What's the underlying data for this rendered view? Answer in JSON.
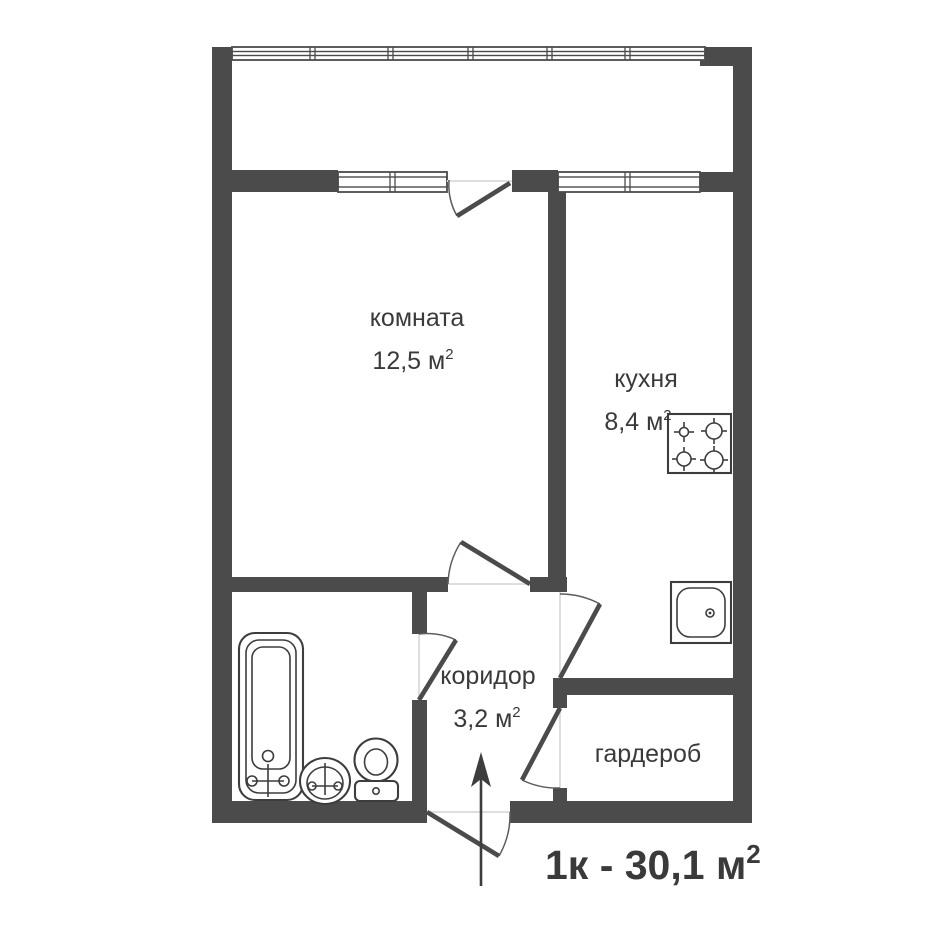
{
  "plan": {
    "type": "floor-plan",
    "rooms": [
      {
        "name": "комната",
        "area": "12,5 м",
        "area_sup": "2"
      },
      {
        "name": "кухня",
        "area": "8,4 м",
        "area_sup": "2"
      },
      {
        "name": "коридор",
        "area": "3,2 м",
        "area_sup": "2"
      },
      {
        "name": "гардероб"
      }
    ],
    "total_label": "1к - 30,1 м",
    "total_sup": "2",
    "colors": {
      "walls": "#4b4b4b",
      "fixtures": "#3d3d3d",
      "text": "#3a3a3a",
      "accent": "#cf2a2a",
      "background": "#ffffff"
    },
    "icons": {
      "bathtub": "bathtub-icon",
      "bathroom_sink": "bathroom-sink-icon",
      "toilet": "toilet-icon",
      "stove": "stove-icon",
      "kitchen_sink": "kitchen-sink-icon",
      "entrance_arrow": "entrance-arrow-icon"
    }
  }
}
